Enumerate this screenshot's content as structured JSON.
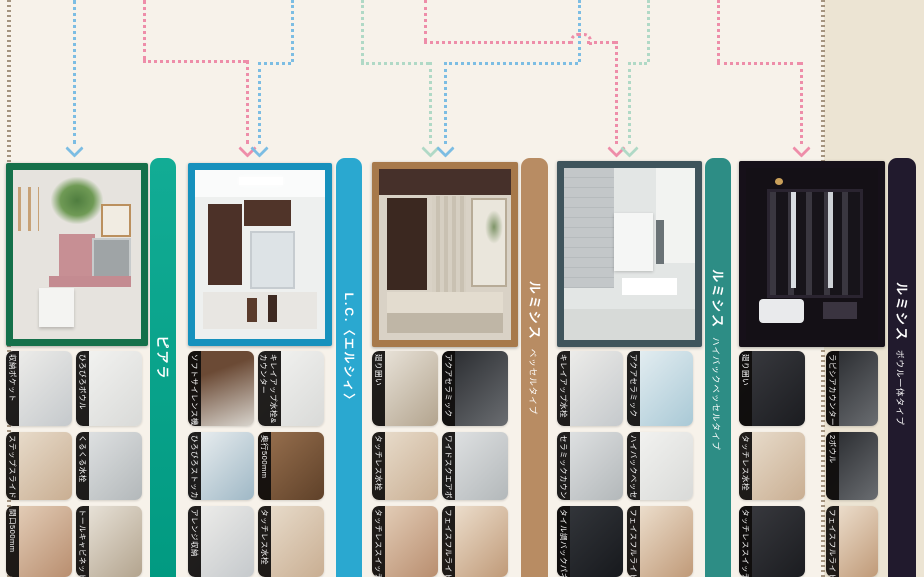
{
  "page": {
    "description": "洗面化粧台 ラインアップ比較ページ",
    "background_left": "#f7f2ea",
    "background_right": "#ece4d3",
    "divider_color": "#96846d"
  },
  "flow_arrows": [
    {
      "color_name": "blue",
      "color": "#7cbde3",
      "target": "ピアラ"
    },
    {
      "color_name": "pink",
      "color": "#ee8da9",
      "target": "L.C.〈エルシィ〉"
    },
    {
      "color_name": "blue",
      "color": "#7cbde3",
      "target": "L.C.〈エルシィ〉"
    },
    {
      "color_name": "green",
      "color": "#b0d9c6",
      "target": "ルミシス ベッセルタイプ"
    },
    {
      "color_name": "blue",
      "color": "#7cbde3",
      "target": "ルミシス ベッセルタイプ"
    },
    {
      "color_name": "pink",
      "color": "#ee8da9",
      "target": "ルミシス ハイバックベッセルタイプ"
    },
    {
      "color_name": "green",
      "color": "#b0d9c6",
      "target": "ルミシス ハイバックベッセルタイプ"
    },
    {
      "color_name": "pink",
      "color": "#ee8da9",
      "target": "ルミシス ボウル一体タイプ"
    }
  ],
  "columns": [
    {
      "name": "ピアラ",
      "banner_color": "#07a28a",
      "frame_color": "#15704a",
      "features": [
        {
          "label": "収納ポケット"
        },
        {
          "label": "ひろびろボウル"
        },
        {
          "label": "ステップスライド"
        },
        {
          "label": "くるくる水栓"
        },
        {
          "label": "間口500mm"
        },
        {
          "label": "トールキャビネット"
        }
      ]
    },
    {
      "name": "L.C.〈エルシィ〉",
      "banner_color": "#2aa8d0",
      "frame_color": "#1691bd",
      "features": [
        {
          "label": "ソフトサイレンス機構"
        },
        {
          "label": "キレイアップ水栓&",
          "label2": "カウンター"
        },
        {
          "label": "ひろびろストッカー"
        },
        {
          "label": "奥行500mm"
        },
        {
          "label": "アレンジ収納"
        },
        {
          "label": "タッチレス水栓"
        }
      ]
    },
    {
      "name": "ルミシス",
      "sub": "ベッセルタイプ",
      "banner_color": "#b88c63",
      "frame_color": "#a7794b",
      "features": [
        {
          "label": "廻り囲い"
        },
        {
          "label": "アクアセラミック"
        },
        {
          "label": "タッチレス水栓"
        },
        {
          "label": "ワイドスクエアボウル"
        },
        {
          "label": "タッチレススイッチ"
        },
        {
          "label": "フェイスフルライト"
        }
      ]
    },
    {
      "name": "ルミシス",
      "sub": "ハイバックベッセルタイプ",
      "banner_color": "#2d8d85",
      "frame_color": "#3f545c",
      "features": [
        {
          "label": "キレイアップ水栓"
        },
        {
          "label": "アクアセラミック"
        },
        {
          "label": "セラミックカウンター"
        },
        {
          "label": "ハイバックベッセルボウル"
        },
        {
          "label": "タイル調バックパネル"
        },
        {
          "label": "フェイスフルライト"
        }
      ]
    },
    {
      "name": "ルミシス",
      "sub": "ボウル一体タイプ",
      "banner_color": "#211a2d",
      "frame_color": "#161019",
      "features": [
        {
          "label": "廻り囲い"
        },
        {
          "label": "ラピシアカウンター"
        },
        {
          "label": "タッチレス水栓"
        },
        {
          "label": "2ボウル"
        },
        {
          "label": "タッチレススイッチ"
        },
        {
          "label": "フェイスフルライト"
        }
      ]
    }
  ]
}
